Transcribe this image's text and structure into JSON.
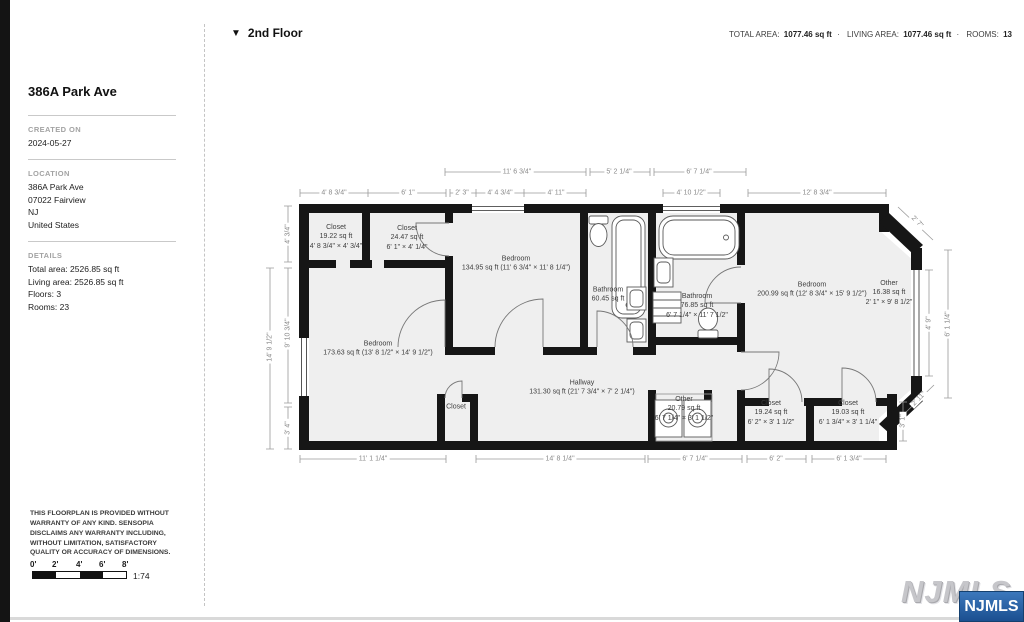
{
  "sidebar": {
    "title": "386A Park Ave",
    "created": {
      "label": "CREATED ON",
      "value": "2024-05-27"
    },
    "location": {
      "label": "LOCATION",
      "lines": [
        "386A Park Ave",
        "07022 Fairview",
        "NJ",
        "United States"
      ]
    },
    "details": {
      "label": "DETAILS",
      "lines": [
        "Total area: 2526.85 sq ft",
        "Living area: 2526.85 sq ft",
        "Floors: 3",
        "Rooms: 23"
      ]
    },
    "disclaimer": "THIS FLOORPLAN IS PROVIDED WITHOUT WARRANTY OF ANY KIND. SENSOPIA DISCLAIMS ANY WARRANTY INCLUDING, WITHOUT LIMITATION, SATISFACTORY QUALITY OR ACCURACY OF DIMENSIONS.",
    "scale": {
      "ticks": [
        "0'",
        "2'",
        "4'",
        "6'",
        "8'"
      ],
      "ratio": "1:74"
    }
  },
  "header": {
    "collapse_icon": "▼",
    "floor_label": "2nd Floor",
    "stats": {
      "total_area_label": "TOTAL AREA:",
      "total_area_value": "1077.46 sq ft",
      "sep1": "·",
      "living_area_label": "LIVING AREA:",
      "living_area_value": "1077.46 sq ft",
      "sep2": "·",
      "rooms_label": "ROOMS:",
      "rooms_value": "13"
    }
  },
  "floorplan": {
    "rooms": [
      {
        "lines": [
          "Closet",
          "19.22 sq ft",
          "4' 8 3/4\" × 4' 3/4\""
        ]
      },
      {
        "lines": [
          "Closet",
          "24.47 sq ft",
          "6' 1\" × 4' 1/4\""
        ]
      },
      {
        "lines": [
          "Bedroom",
          "134.95 sq ft (11' 6 3/4\" × 11' 8 1/4\")"
        ]
      },
      {
        "lines": [
          "Bathroom",
          "60.45 sq ft"
        ]
      },
      {
        "lines": [
          "Bathroom",
          "76.85 sq ft",
          "6' 7 1/4\" × 11' 7 1/2\""
        ]
      },
      {
        "lines": [
          "Bedroom",
          "200.99 sq ft (12' 8 3/4\" × 15' 9 1/2\")"
        ]
      },
      {
        "lines": [
          "Other",
          "16.38 sq ft",
          "2' 1\" × 9' 8 1/2\""
        ]
      },
      {
        "lines": [
          "Bedroom",
          "173.63 sq ft (13' 8 1/2\" × 14' 9 1/2\")"
        ]
      },
      {
        "lines": [
          "Hallway",
          "131.30 sq ft (21' 7 3/4\" × 7' 2 1/4\")"
        ]
      },
      {
        "lines": [
          "Closet"
        ]
      },
      {
        "lines": [
          "Other",
          "20.79 sq ft",
          "6' 7 1/4\" × 3' 1 1/2\""
        ]
      },
      {
        "lines": [
          "Closet",
          "19.24 sq ft",
          "6' 2\" × 3' 1 1/2\""
        ]
      },
      {
        "lines": [
          "Closet",
          "19.03 sq ft",
          "6' 1 3/4\" × 3' 1 1/4\""
        ]
      }
    ],
    "dimensions": {
      "top_outer": [
        "11' 6 3/4\"",
        "5' 2 1/4\"",
        "6' 7 1/4\""
      ],
      "top": [
        "4' 8 3/4\"",
        "6' 1\"",
        "2' 3\"",
        "4' 4 3/4\"",
        "4' 11\"",
        "4' 10 1/2\"",
        "12' 8 3/4\""
      ],
      "left": [
        "4' 3/4\"",
        "14' 9 1/2\"",
        "9' 10 3/4\"",
        "3' 4\""
      ],
      "bottom": [
        "11' 1 1/4\"",
        "14' 8 1/4\"",
        "6' 7 1/4\"",
        "6' 2\"",
        "6' 1 3/4\""
      ],
      "right": [
        "2' 7\"",
        "4' 9\"",
        "6' 1 1/4\"",
        "2' 11\"",
        "3' 1\""
      ]
    }
  },
  "watermark": {
    "background_text": "NJMLS",
    "badge_text": "NJMLS",
    "badge_color": "#1b4f90"
  }
}
